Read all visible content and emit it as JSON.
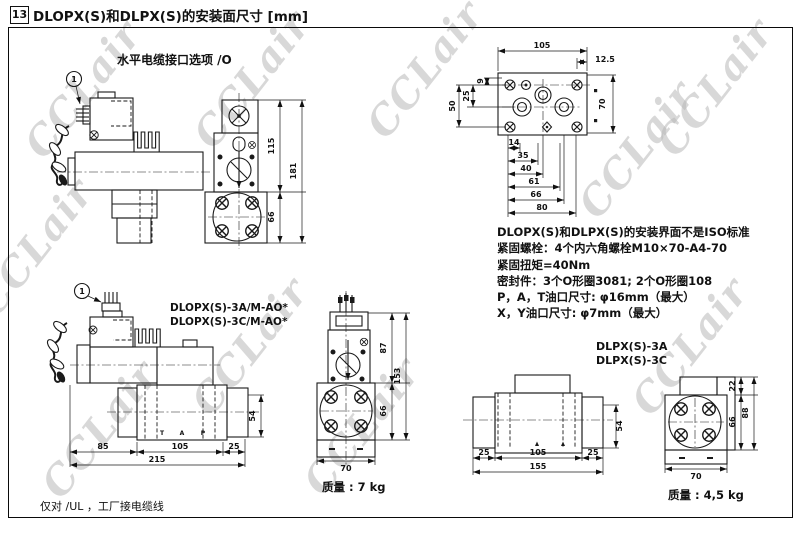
{
  "page": {
    "section_number": "13",
    "title": "DLOPX(S)和DLPX(S)的安装面尺寸 [mm]",
    "watermark": "CCLair",
    "footnote": "仅对 /UL ，工厂接电缆线"
  },
  "cable_option": {
    "caption": "水平电缆接口选项 /O",
    "note_ref": "1",
    "dims": {
      "height_top": "115",
      "height_total": "181",
      "height_bottom": "66"
    }
  },
  "mounting_face": {
    "dims": {
      "width": "105",
      "offset_right": "12.5",
      "left_9": "9",
      "left_25": "25",
      "left_50": "50",
      "right_70": "70",
      "chain_14": "14",
      "chain_35": "35",
      "chain_40": "40",
      "chain_61": "61",
      "chain_66": "66",
      "chain_80": "80"
    }
  },
  "specs": {
    "lines": [
      "DLOPX(S)和DLPX(S)的安装界面不是ISO标准",
      "紧固螺栓：4个内六角螺栓M10×70-A4-70",
      "紧固扭矩=40Nm",
      "密封件：3个O形圈3081; 2个O形圈108",
      "P，A，T油口尺寸: φ16mm（最大）",
      "X，Y油口尺寸: φ7mm（最大）"
    ]
  },
  "dlopx": {
    "note_ref": "1",
    "model_a": "DLOPX(S)-3A/M-AO*",
    "model_c": "DLOPX(S)-3C/M-AO*",
    "ports": {
      "t": "T",
      "a": "A",
      "p": "P"
    },
    "side_dims": {
      "d85": "85",
      "d105": "105",
      "d25": "25",
      "d215": "215",
      "d54": "54"
    },
    "front_dims": {
      "d87": "87",
      "d153": "153",
      "d66": "66",
      "d70": "70"
    },
    "weight": "质量 : 7 kg"
  },
  "dlpx": {
    "model_a": "DLPX(S)-3A",
    "model_c": "DLPX(S)-3C",
    "side_dims": {
      "d25l": "25",
      "d105": "105",
      "d25r": "25",
      "d155": "155",
      "d54": "54"
    },
    "front_dims": {
      "d22": "22",
      "d88": "88",
      "d66": "66",
      "d70": "70"
    },
    "weight": "质量 : 4,5 kg"
  }
}
